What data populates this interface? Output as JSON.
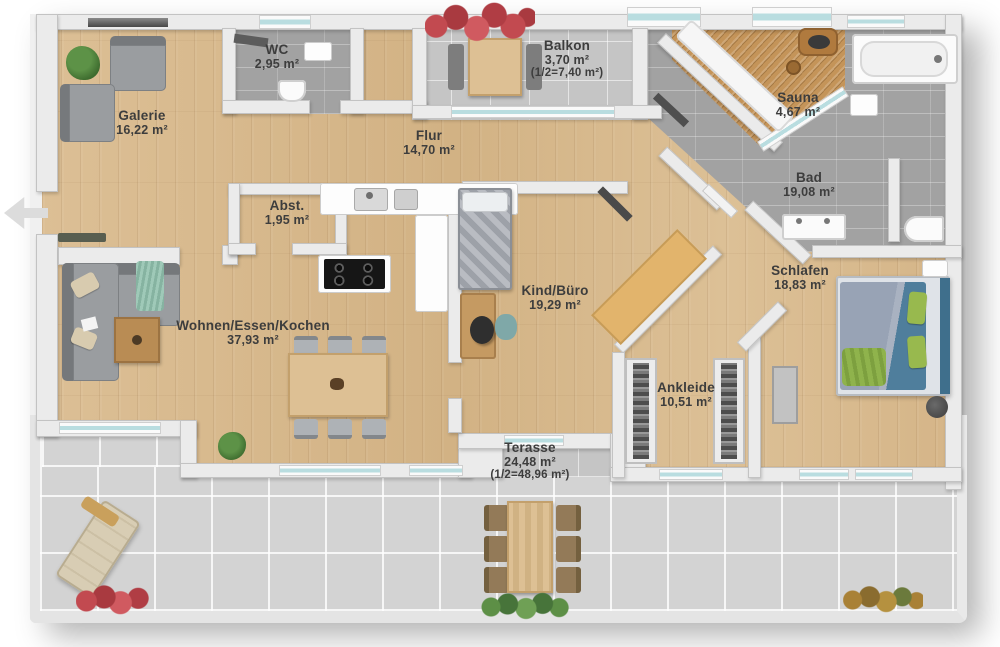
{
  "rooms": [
    {
      "id": "galerie",
      "name": "Galerie",
      "area": "16,22 m²"
    },
    {
      "id": "wc",
      "name": "WC",
      "area": "2,95 m²"
    },
    {
      "id": "flur",
      "name": "Flur",
      "area": "14,70 m²"
    },
    {
      "id": "balkon",
      "name": "Balkon",
      "area": "3,70 m²",
      "half": "(1/2=7,40 m²)"
    },
    {
      "id": "sauna",
      "name": "Sauna",
      "area": "4,67 m²"
    },
    {
      "id": "bad",
      "name": "Bad",
      "area": "19,08 m²"
    },
    {
      "id": "abst",
      "name": "Abst.",
      "area": "1,95 m²"
    },
    {
      "id": "wohnen",
      "name": "Wohnen/Essen/Kochen",
      "area": "37,93 m²"
    },
    {
      "id": "kind",
      "name": "Kind/Büro",
      "area": "19,29 m²"
    },
    {
      "id": "schlafen",
      "name": "Schlafen",
      "area": "18,83 m²"
    },
    {
      "id": "ankleide",
      "name": "Ankleide",
      "area": "10,51 m²"
    },
    {
      "id": "terasse",
      "name": "Terasse",
      "area": "24,48 m²",
      "half": "(1/2=48,96 m²)"
    }
  ],
  "colors": {
    "wood_floor": "#d7b88c",
    "bath_tile": "#a2a2a2",
    "terrace_tile": "#d3d3d3",
    "wall": "#ebebeb",
    "window_glass": "#b9dde0",
    "sauna_wood": "#c49459",
    "wardrobe_wood": "#e2b46c",
    "flower_red": "#c24a50",
    "plant_green": "#5d9247",
    "bed_blue": "#4f7e9c",
    "pillow_green": "#98b94e",
    "throw_mint": "#9fc9b8"
  }
}
